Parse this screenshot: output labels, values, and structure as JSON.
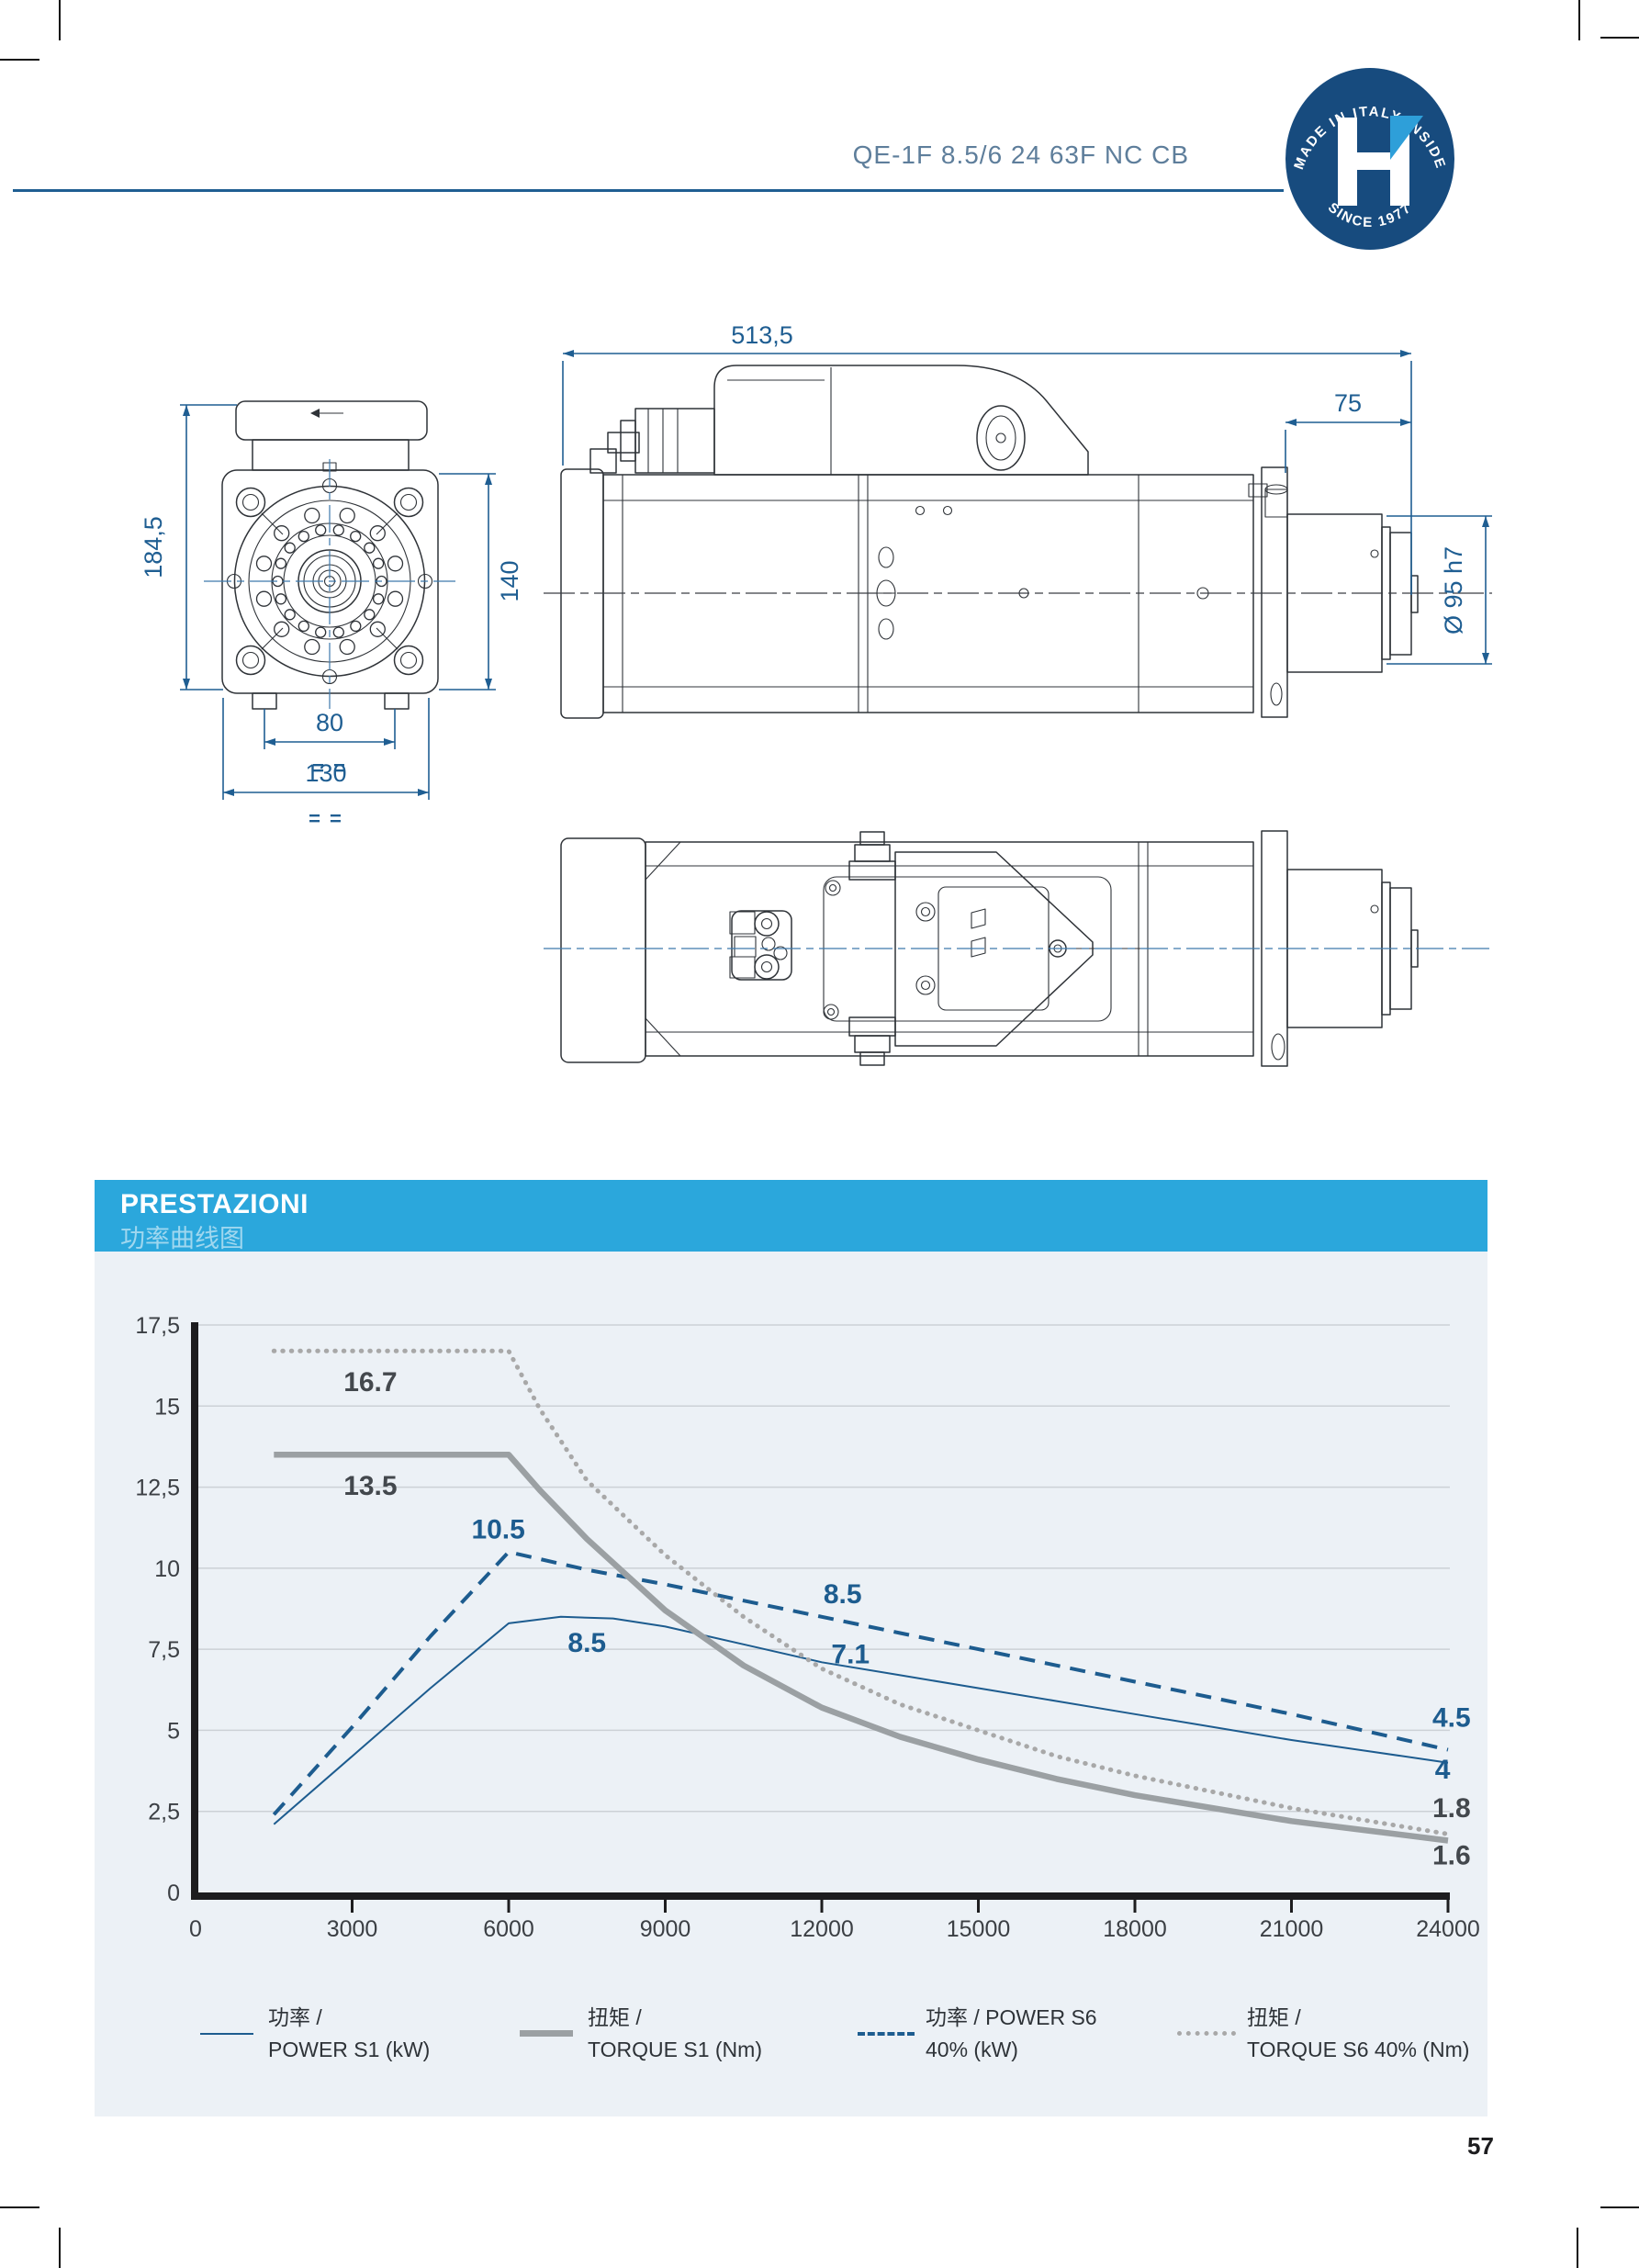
{
  "page": {
    "number": "57"
  },
  "header": {
    "title": "QE-1F 8.5/6 24 63F NC CB",
    "title_color": "#5E7E9B",
    "rule_color": "#1F5E92",
    "badge": {
      "top_text": "MADE IN ITALY INSIDE",
      "bottom_text": "SINCE 1977",
      "letter": "H",
      "bg_color": "#174B7E",
      "accent_color": "#2E9FD9"
    }
  },
  "drawings": {
    "front_view": {
      "dim_height": "184,5",
      "dim_body": "140",
      "dim_slot": "80",
      "dim_width": "130",
      "dim_eq": "= ="
    },
    "side_view": {
      "dim_length": "513,5",
      "dim_nose": "75",
      "dim_shaft": "Ø 95 h7"
    }
  },
  "performance": {
    "title": "PRESTAZIONI",
    "subtitle": "功率曲线图",
    "header_bg": "#2BA7DC",
    "panel_bg": "#ECF1F6"
  },
  "chart_data": {
    "type": "line",
    "title": "",
    "xlabel": "",
    "ylabel": "",
    "xlim": [
      0,
      24000
    ],
    "ylim": [
      0,
      17.5
    ],
    "grid": true,
    "x_ticks": [
      {
        "label": "0",
        "value": 0
      },
      {
        "label": "3000",
        "value": 3000
      },
      {
        "label": "6000",
        "value": 6000
      },
      {
        "label": "9000",
        "value": 9000
      },
      {
        "label": "12000",
        "value": 12000
      },
      {
        "label": "15000",
        "value": 15000
      },
      {
        "label": "18000",
        "value": 18000
      },
      {
        "label": "21000",
        "value": 21000
      },
      {
        "label": "24000",
        "value": 24000
      }
    ],
    "y_ticks": [
      {
        "label": "17,5",
        "value": 17.5
      },
      {
        "label": "15",
        "value": 15
      },
      {
        "label": "12,5",
        "value": 12.5
      },
      {
        "label": "10",
        "value": 10
      },
      {
        "label": "7,5",
        "value": 7.5
      },
      {
        "label": "5",
        "value": 5
      },
      {
        "label": "2,5",
        "value": 2.5
      },
      {
        "label": "0",
        "value": 0
      }
    ],
    "series": [
      {
        "name": "POWER S1 (kW)",
        "style": "solid-thin",
        "color": "#1D5C8F",
        "width": 2,
        "points": [
          [
            1500,
            2.1
          ],
          [
            3000,
            4.2
          ],
          [
            4500,
            6.3
          ],
          [
            6000,
            8.3
          ],
          [
            7000,
            8.5
          ],
          [
            8000,
            8.45
          ],
          [
            9000,
            8.2
          ],
          [
            10500,
            7.65
          ],
          [
            12000,
            7.1
          ],
          [
            13500,
            6.7
          ],
          [
            15000,
            6.3
          ],
          [
            16500,
            5.9
          ],
          [
            18000,
            5.5
          ],
          [
            19500,
            5.1
          ],
          [
            21000,
            4.7
          ],
          [
            22500,
            4.35
          ],
          [
            24000,
            4.0
          ]
        ]
      },
      {
        "name": "POWER S6 40% (kW)",
        "style": "dashed",
        "color": "#1D5C8F",
        "width": 4,
        "dash": "17 11",
        "points": [
          [
            1500,
            2.4
          ],
          [
            3000,
            5.1
          ],
          [
            4500,
            7.9
          ],
          [
            6000,
            10.5
          ],
          [
            7500,
            9.95
          ],
          [
            9000,
            9.5
          ],
          [
            10500,
            9.0
          ],
          [
            12000,
            8.5
          ],
          [
            13500,
            8.0
          ],
          [
            15000,
            7.5
          ],
          [
            16500,
            7.0
          ],
          [
            18000,
            6.5
          ],
          [
            19500,
            6.0
          ],
          [
            21000,
            5.5
          ],
          [
            22500,
            4.95
          ],
          [
            24000,
            4.4
          ]
        ]
      },
      {
        "name": "TORQUE S1 (Nm)",
        "style": "solid-thick",
        "color": "#9BA0A3",
        "width": 6.5,
        "points": [
          [
            1500,
            13.5
          ],
          [
            6000,
            13.5
          ],
          [
            6600,
            12.4
          ],
          [
            7500,
            10.9
          ],
          [
            9000,
            8.7
          ],
          [
            10500,
            7.0
          ],
          [
            12000,
            5.7
          ],
          [
            13500,
            4.8
          ],
          [
            15000,
            4.1
          ],
          [
            16500,
            3.5
          ],
          [
            18000,
            3.0
          ],
          [
            19500,
            2.6
          ],
          [
            21000,
            2.2
          ],
          [
            22500,
            1.9
          ],
          [
            24000,
            1.6
          ]
        ]
      },
      {
        "name": "TORQUE S6 40% (Nm)",
        "style": "dotted",
        "color": "#A8A8A8",
        "width": 5,
        "dash": "0.5 9",
        "linecap": "round",
        "points": [
          [
            1500,
            16.7
          ],
          [
            6000,
            16.7
          ],
          [
            6600,
            14.9
          ],
          [
            7500,
            12.7
          ],
          [
            9000,
            10.4
          ],
          [
            10500,
            8.5
          ],
          [
            12000,
            6.9
          ],
          [
            13500,
            5.8
          ],
          [
            15000,
            5.0
          ],
          [
            16500,
            4.2
          ],
          [
            18000,
            3.6
          ],
          [
            19500,
            3.1
          ],
          [
            21000,
            2.6
          ],
          [
            22500,
            2.2
          ],
          [
            24000,
            1.8
          ]
        ]
      }
    ],
    "annotations": [
      {
        "text": "16.7",
        "x": 3350,
        "y": 15.75,
        "color": "#43484D"
      },
      {
        "text": "13.5",
        "x": 3350,
        "y": 12.55,
        "color": "#43484D"
      },
      {
        "text": "10.5",
        "x": 5800,
        "y": 11.2,
        "color": "#1D5C8F"
      },
      {
        "text": "8.5",
        "x": 7500,
        "y": 7.7,
        "color": "#1D5C8F"
      },
      {
        "text": "8.5",
        "x": 12400,
        "y": 9.2,
        "color": "#1D5C8F"
      },
      {
        "text": "7.1",
        "x": 12550,
        "y": 7.35,
        "color": "#1D5C8F"
      },
      {
        "text": "4.5",
        "x": 23700,
        "y": 5.4,
        "color": "#1D5C8F",
        "anchor": "start"
      },
      {
        "text": "4",
        "x": 23750,
        "y": 3.8,
        "color": "#1D5C8F",
        "anchor": "start"
      },
      {
        "text": "1.8",
        "x": 23700,
        "y": 2.6,
        "color": "#43484D",
        "anchor": "start"
      },
      {
        "text": "1.6",
        "x": 23700,
        "y": 1.15,
        "color": "#43484D",
        "anchor": "start"
      }
    ],
    "legend_position": "bottom"
  },
  "legend": [
    {
      "swatch": "solid-thin-blue",
      "label_cn": "功率 /",
      "label_en": "POWER S1 (kW)"
    },
    {
      "swatch": "solid-thick-gray",
      "label_cn": "扭矩 /",
      "label_en": "TORQUE S1 (Nm)"
    },
    {
      "swatch": "dashed-blue",
      "label_cn": "功率 / POWER S6",
      "label_en": "40% (kW)"
    },
    {
      "swatch": "dotted-gray",
      "label_cn": "扭矩 /",
      "label_en": "TORQUE S6 40% (Nm)"
    }
  ]
}
